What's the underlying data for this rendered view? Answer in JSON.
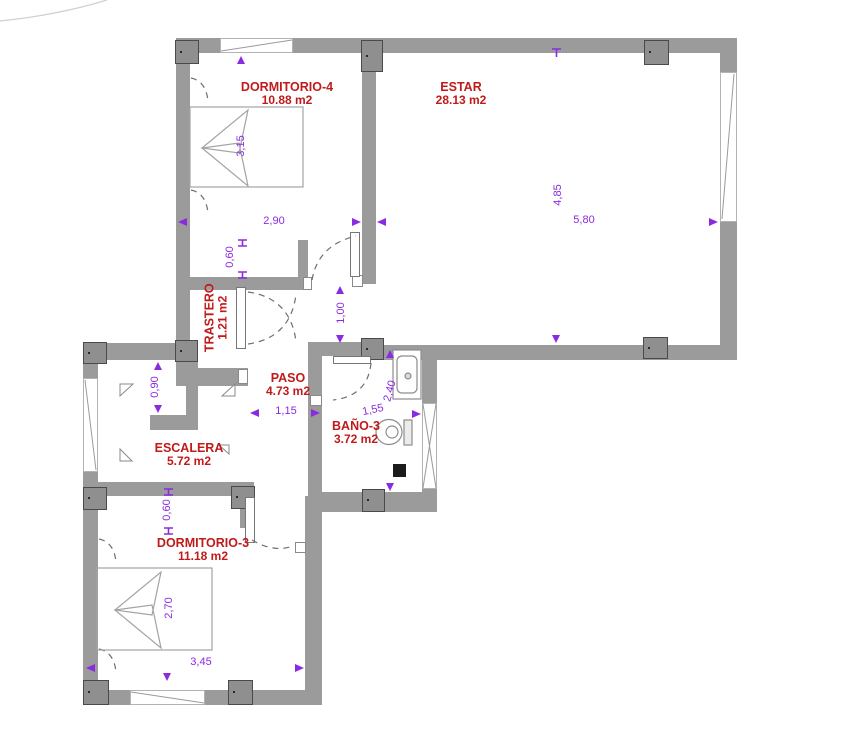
{
  "plan": {
    "rooms": [
      {
        "id": "dormitorio4",
        "name": "DORMITORIO-4",
        "area": "10.88 m2"
      },
      {
        "id": "estar",
        "name": "ESTAR",
        "area": "28.13 m2"
      },
      {
        "id": "trastero",
        "name": "TRASTERO",
        "area": "1.21 m2"
      },
      {
        "id": "paso",
        "name": "PASO",
        "area": "4.73 m2"
      },
      {
        "id": "bano3",
        "name": "BAÑO-3",
        "area": "3.72 m2"
      },
      {
        "id": "escalera",
        "name": "ESCALERA",
        "area": "5.72 m2"
      },
      {
        "id": "dormitorio3",
        "name": "DORMITORIO-3",
        "area": "11.18 m2"
      }
    ],
    "dimensions": [
      {
        "id": "dorm4-width",
        "value": "2,90"
      },
      {
        "id": "dorm4-depth",
        "value": "3,15"
      },
      {
        "id": "trastero-door",
        "value": "0,60"
      },
      {
        "id": "paso-opening",
        "value": "1,00"
      },
      {
        "id": "estar-depth",
        "value": "4,85"
      },
      {
        "id": "estar-width",
        "value": "5,80"
      },
      {
        "id": "paso-width",
        "value": "1,15"
      },
      {
        "id": "bano-width",
        "value": "1,55"
      },
      {
        "id": "bano-depth",
        "value": "2,40"
      },
      {
        "id": "escalera-pass",
        "value": "0,90"
      },
      {
        "id": "dorm3-door",
        "value": "0,60"
      },
      {
        "id": "dorm3-depth",
        "value": "2,70"
      },
      {
        "id": "dorm3-width",
        "value": "3,45"
      }
    ],
    "colors": {
      "room_label": "#c01a1a",
      "dimension": "#8A2BE2",
      "wall": "#9b9b9b"
    }
  }
}
